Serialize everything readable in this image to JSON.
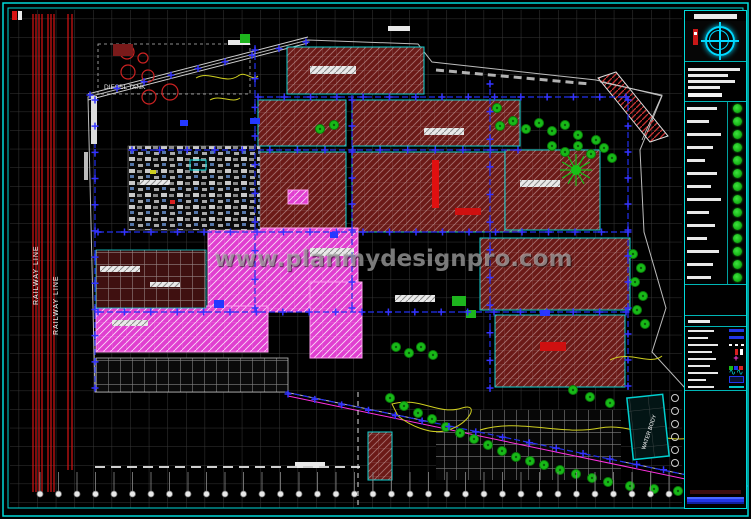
{
  "watermark": {
    "text": "www.planmydesignpro.com"
  },
  "labels": {
    "railway_line_1": "RAILWAY LINE",
    "railway_line_2": "RAILWAY LINE",
    "diesel_tank": "DIESEL TANK",
    "water_body": "WATER BODY"
  },
  "palette": {
    "background": "#000000",
    "border_cyan": "#00d9d9",
    "railway_red": "#d81414",
    "building_maroon": "#6b1a17",
    "building_magenta": "#e03fd0",
    "road_blue": "#2230ee",
    "tree_green": "#18b918",
    "accent_yellow": "#cfcf20",
    "grid_gray": "#6e6e6e",
    "white": "#ffffff",
    "footer_blue": "#2236e8"
  },
  "title_block": {
    "logo_icon": "globe-compass-logo",
    "info_line_count": 4,
    "legend_trees": {
      "rows": 14,
      "symbol": "tree-icon"
    },
    "legend_lines": {
      "rows": 9,
      "symbols": [
        "blue-bar",
        "blue-bar",
        "white-dash",
        "red-tick",
        "pink-cross",
        "multi-sq",
        "wave",
        "blue-rect",
        "cyan-bar"
      ]
    }
  },
  "site": {
    "boundary_post_count": 38,
    "railway_track_count": 9
  }
}
